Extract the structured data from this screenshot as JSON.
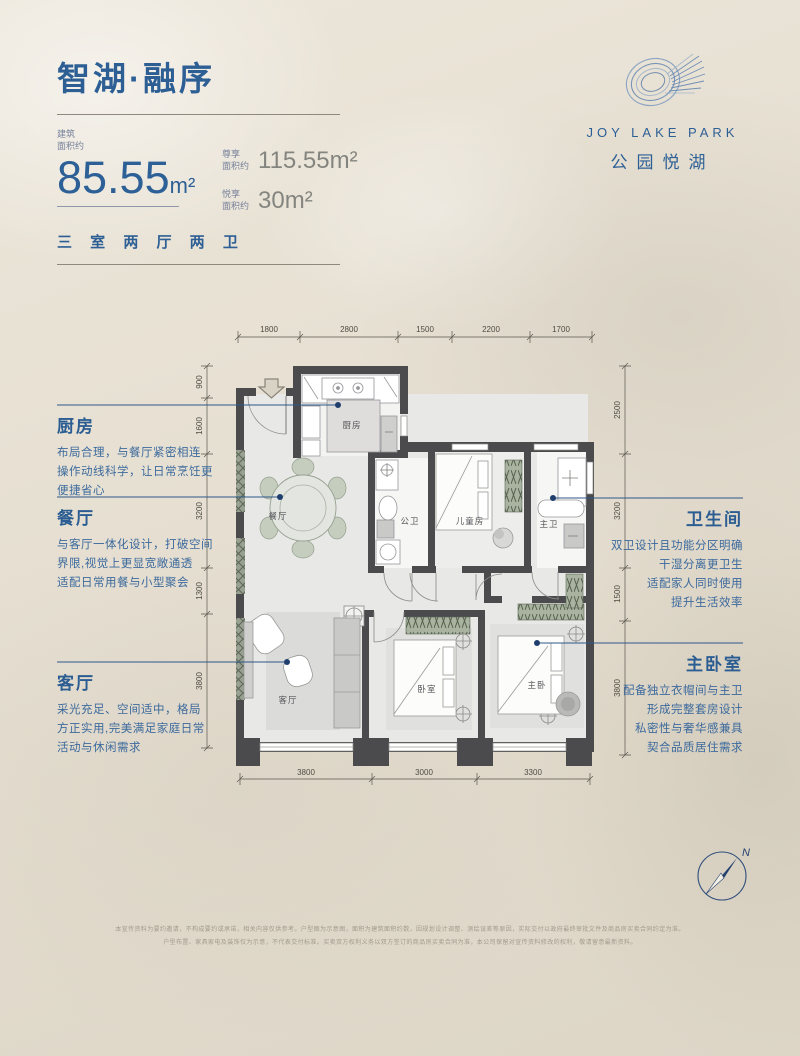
{
  "header": {
    "title": "智湖·融序",
    "primary_area": {
      "label_line1": "建筑",
      "label_line2": "面积约",
      "value": "85.55",
      "unit": "m²"
    },
    "secondary_areas": [
      {
        "label_line1": "尊享",
        "label_line2": "面积约",
        "value": "115.55m²"
      },
      {
        "label_line1": "悦享",
        "label_line2": "面积约",
        "value": "30m²"
      }
    ],
    "layout_type": "三 室 两 厅 两 卫"
  },
  "logo": {
    "name_en": "JOY LAKE PARK",
    "name_cn": "公园悦湖"
  },
  "annotations": {
    "kitchen": {
      "title": "厨房",
      "lines": [
        "布局合理，与餐厅紧密相连",
        "操作动线科学，让日常烹饪更",
        "便捷省心"
      ]
    },
    "dining": {
      "title": "餐厅",
      "lines": [
        "与客厅一体化设计，打破空间",
        "界限,视觉上更显宽敞通透",
        "适配日常用餐与小型聚会"
      ]
    },
    "living": {
      "title": "客厅",
      "lines": [
        "采光充足、空间适中，格局",
        "方正实用,完美满足家庭日常",
        "活动与休闲需求"
      ]
    },
    "bathroom": {
      "title": "卫生间",
      "lines": [
        "双卫设计且功能分区明确",
        "干湿分离更卫生",
        "适配家人同时使用",
        "提升生活效率"
      ]
    },
    "master": {
      "title": "主卧室",
      "lines": [
        "配备独立衣帽间与主卫",
        "形成完整套房设计",
        "私密性与奢华感兼具",
        "契合品质居住需求"
      ]
    }
  },
  "rooms": {
    "kitchen": "厨房",
    "dining": "餐厅",
    "guest_bath": "公卫",
    "kids": "儿童房",
    "master_bath": "主卫",
    "living": "客厅",
    "bedroom": "卧室",
    "master_bed": "主卧"
  },
  "dims": {
    "top": [
      "1800",
      "2800",
      "1500",
      "2200",
      "1700"
    ],
    "bottom": [
      "3800",
      "3000",
      "3300"
    ],
    "left": [
      "900",
      "1600",
      "3200",
      "1300",
      "3800"
    ],
    "right": [
      "2500",
      "3200",
      "1500",
      "3800"
    ]
  },
  "compass": {
    "north_label": "N"
  },
  "disclaimer": {
    "line1": "本宣传资料为要约邀请，不构成要约或承诺，相关内容仅供参考。户型图为示意图，面积为建筑面积约数，因规划设计调整、测绘误差等原因，实际交付以政府最终审批文件及商品房买卖合同约定为准。",
    "line2": "户型布置、家具家电及装饰仅为示意，不代表交付标准。买卖双方权利义务以双方签订的商品房买卖合同为准，本公司保留对宣传资料修改的权利，敬请留意最新资料。"
  },
  "colors": {
    "accent": "#2d5f95",
    "wall": "#4b4b4d",
    "leader": "#2c5788",
    "gray_value": "#85857f"
  }
}
